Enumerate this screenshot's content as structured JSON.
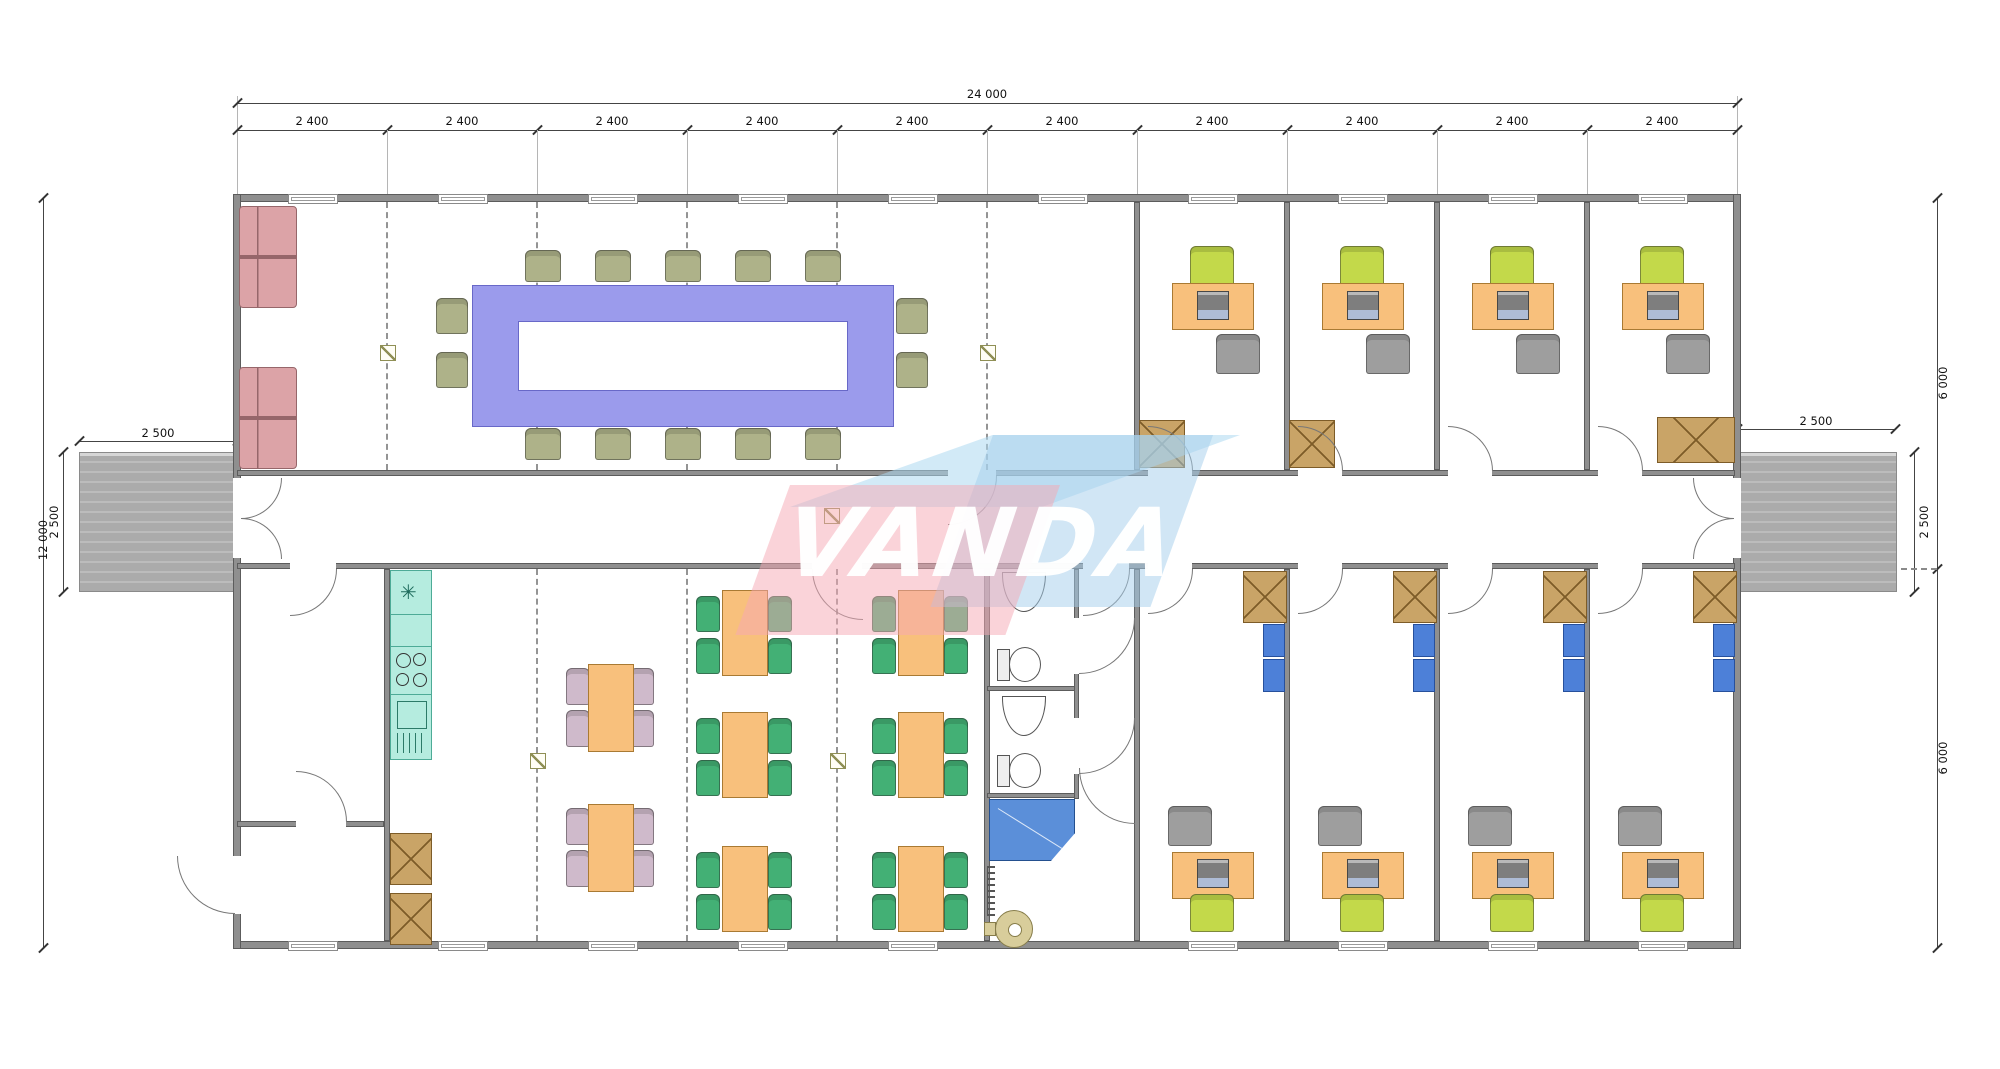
{
  "watermark": {
    "text": "VANDA"
  },
  "dimensions": {
    "top_total": "24 000",
    "top_segments": [
      "2 400",
      "2 400",
      "2 400",
      "2 400",
      "2 400",
      "2 400",
      "2 400",
      "2 400",
      "2 400",
      "2 400"
    ],
    "left_total": "12 000",
    "left_entry_width": "2 500",
    "left_entry_depth": "2 500",
    "right_entry_width": "2 500",
    "right_entry_depth": "2 500",
    "right_upper": "6 000",
    "right_lower": "6 000"
  },
  "symbols": {
    "sink_asterisk": "✳"
  }
}
